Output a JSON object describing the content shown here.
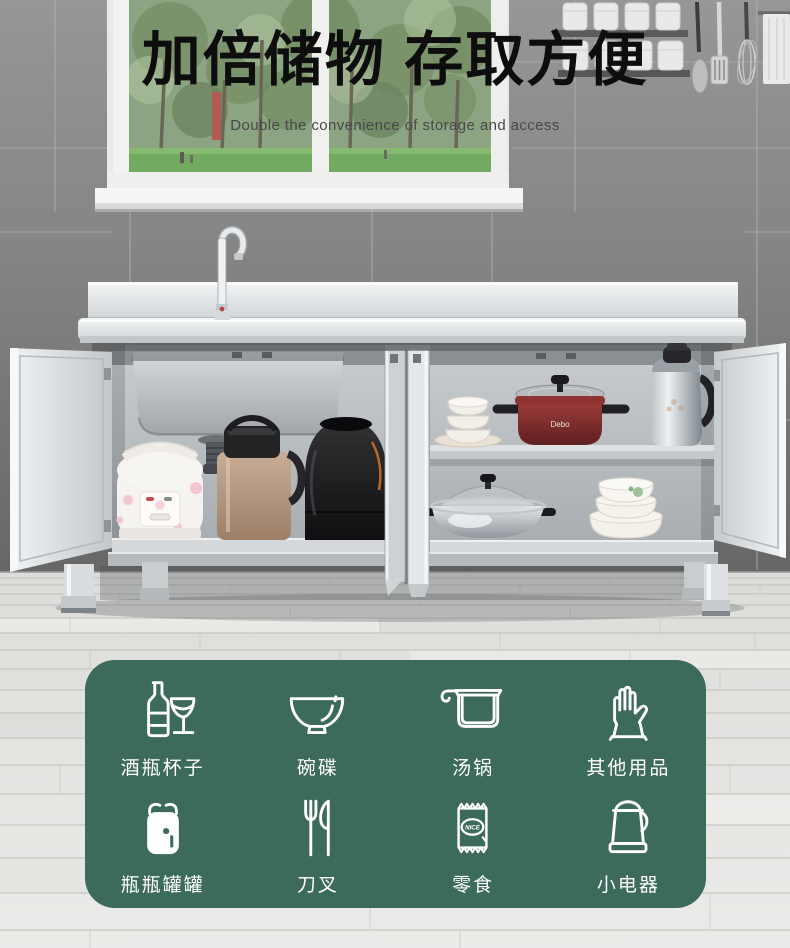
{
  "header": {
    "title": "加倍储物 存取方便",
    "subtitle": "Double the convenience of storage and access"
  },
  "features": {
    "panel_color": "#3c6a5b",
    "items": [
      {
        "icon": "wine-bottle-glass-icon",
        "label": "酒瓶杯子"
      },
      {
        "icon": "bowl-icon",
        "label": "碗碟"
      },
      {
        "icon": "soup-pot-icon",
        "label": "汤锅"
      },
      {
        "icon": "glove-icon",
        "label": "其他用品"
      },
      {
        "icon": "jar-icon",
        "label": "瓶瓶罐罐"
      },
      {
        "icon": "fork-knife-icon",
        "label": "刀叉"
      },
      {
        "icon": "snack-icon",
        "label": "零食",
        "packet_text": "NICE"
      },
      {
        "icon": "kettle-icon",
        "label": "小电器"
      }
    ]
  },
  "photo": {
    "pot_brand_text": "Debo"
  },
  "colors": {
    "headline": "#0d0d0d",
    "subtitle": "#484848",
    "panel_green": "#3c6a5b",
    "icon_stroke": "#ffffff",
    "wall_grey": "#8a8a8a",
    "floor_grey": "#e6e6e4",
    "steel": "#d9dcde",
    "pot_red": "#8f3432"
  }
}
